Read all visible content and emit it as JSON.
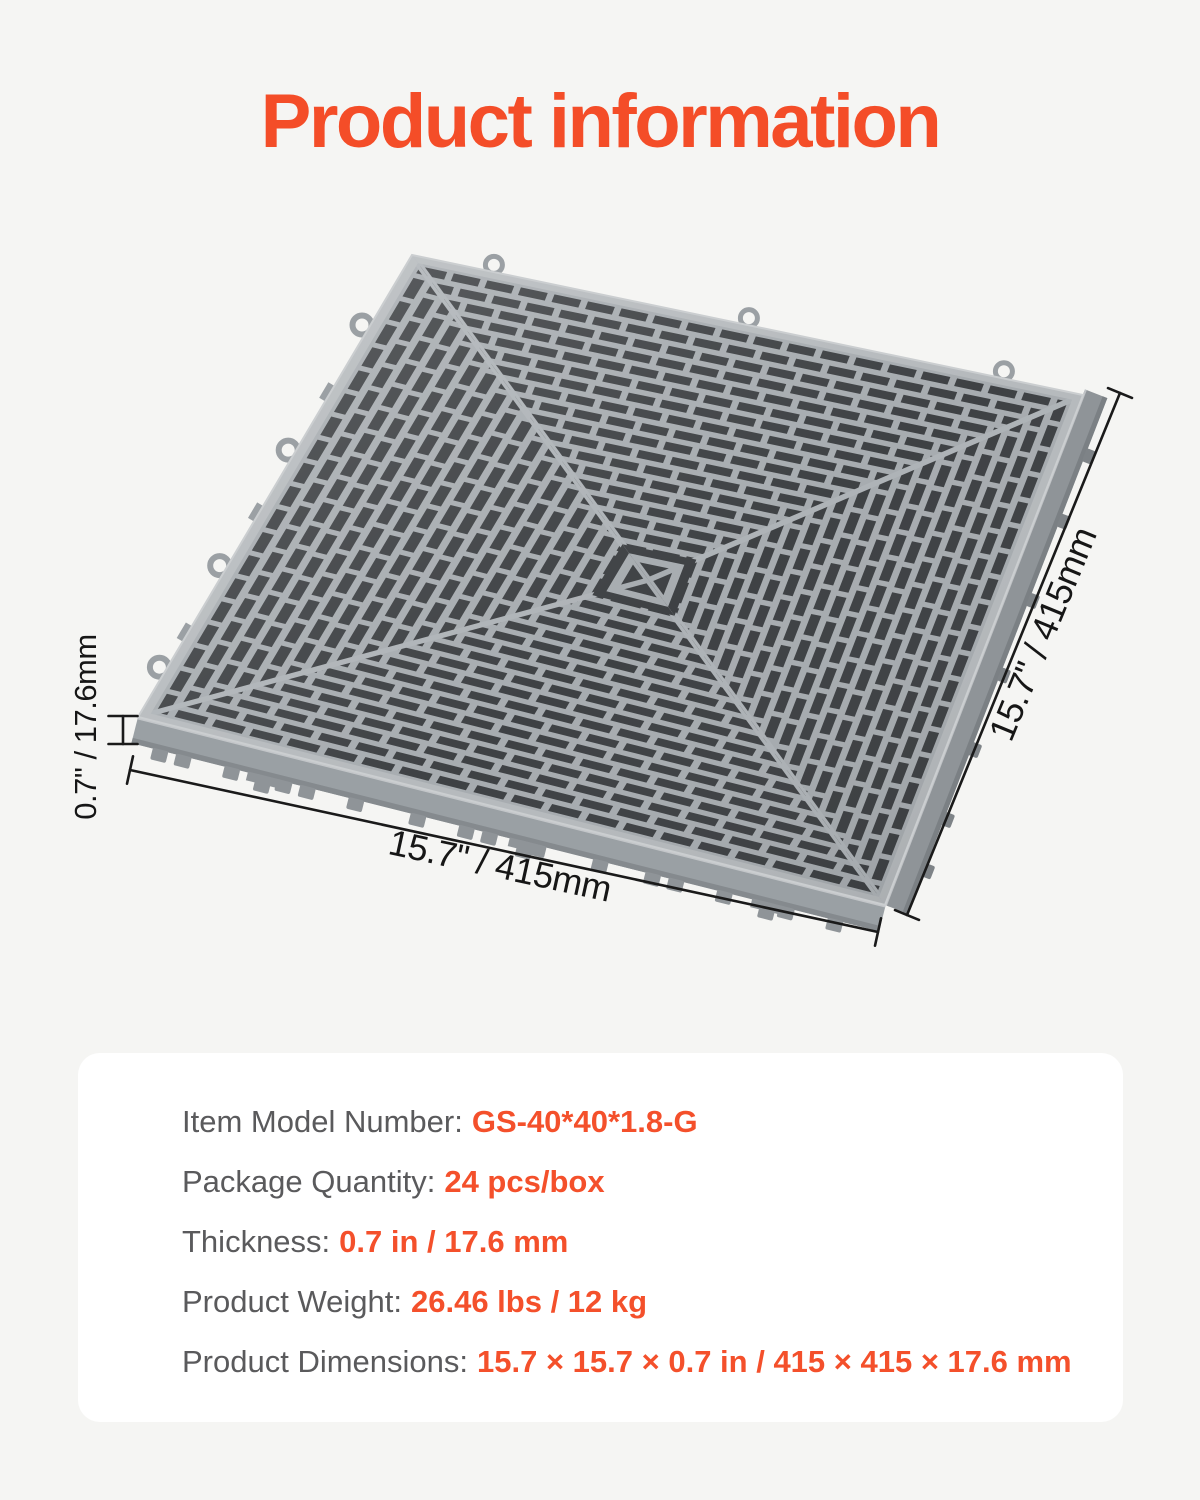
{
  "page": {
    "title": "Product information",
    "accent_color": "#F44D28",
    "background_color": "#F5F5F3"
  },
  "figure": {
    "thickness_label": "0.7\" / 17.6mm",
    "width_label": "15.7\" / 415mm",
    "depth_label": "15.7\" / 415mm"
  },
  "specs": {
    "rows": [
      {
        "label": "Item Model Number:",
        "value": "GS-40*40*1.8-G"
      },
      {
        "label": "Package Quantity:",
        "value": "24 pcs/box"
      },
      {
        "label": "Thickness:",
        "value": "0.7 in / 17.6 mm"
      },
      {
        "label": "Product Weight:",
        "value": "26.46 lbs / 12 kg"
      },
      {
        "label": "Product Dimensions:",
        "value": "15.7 × 15.7 × 0.7 in / 415 × 415 × 17.6 mm"
      }
    ]
  }
}
